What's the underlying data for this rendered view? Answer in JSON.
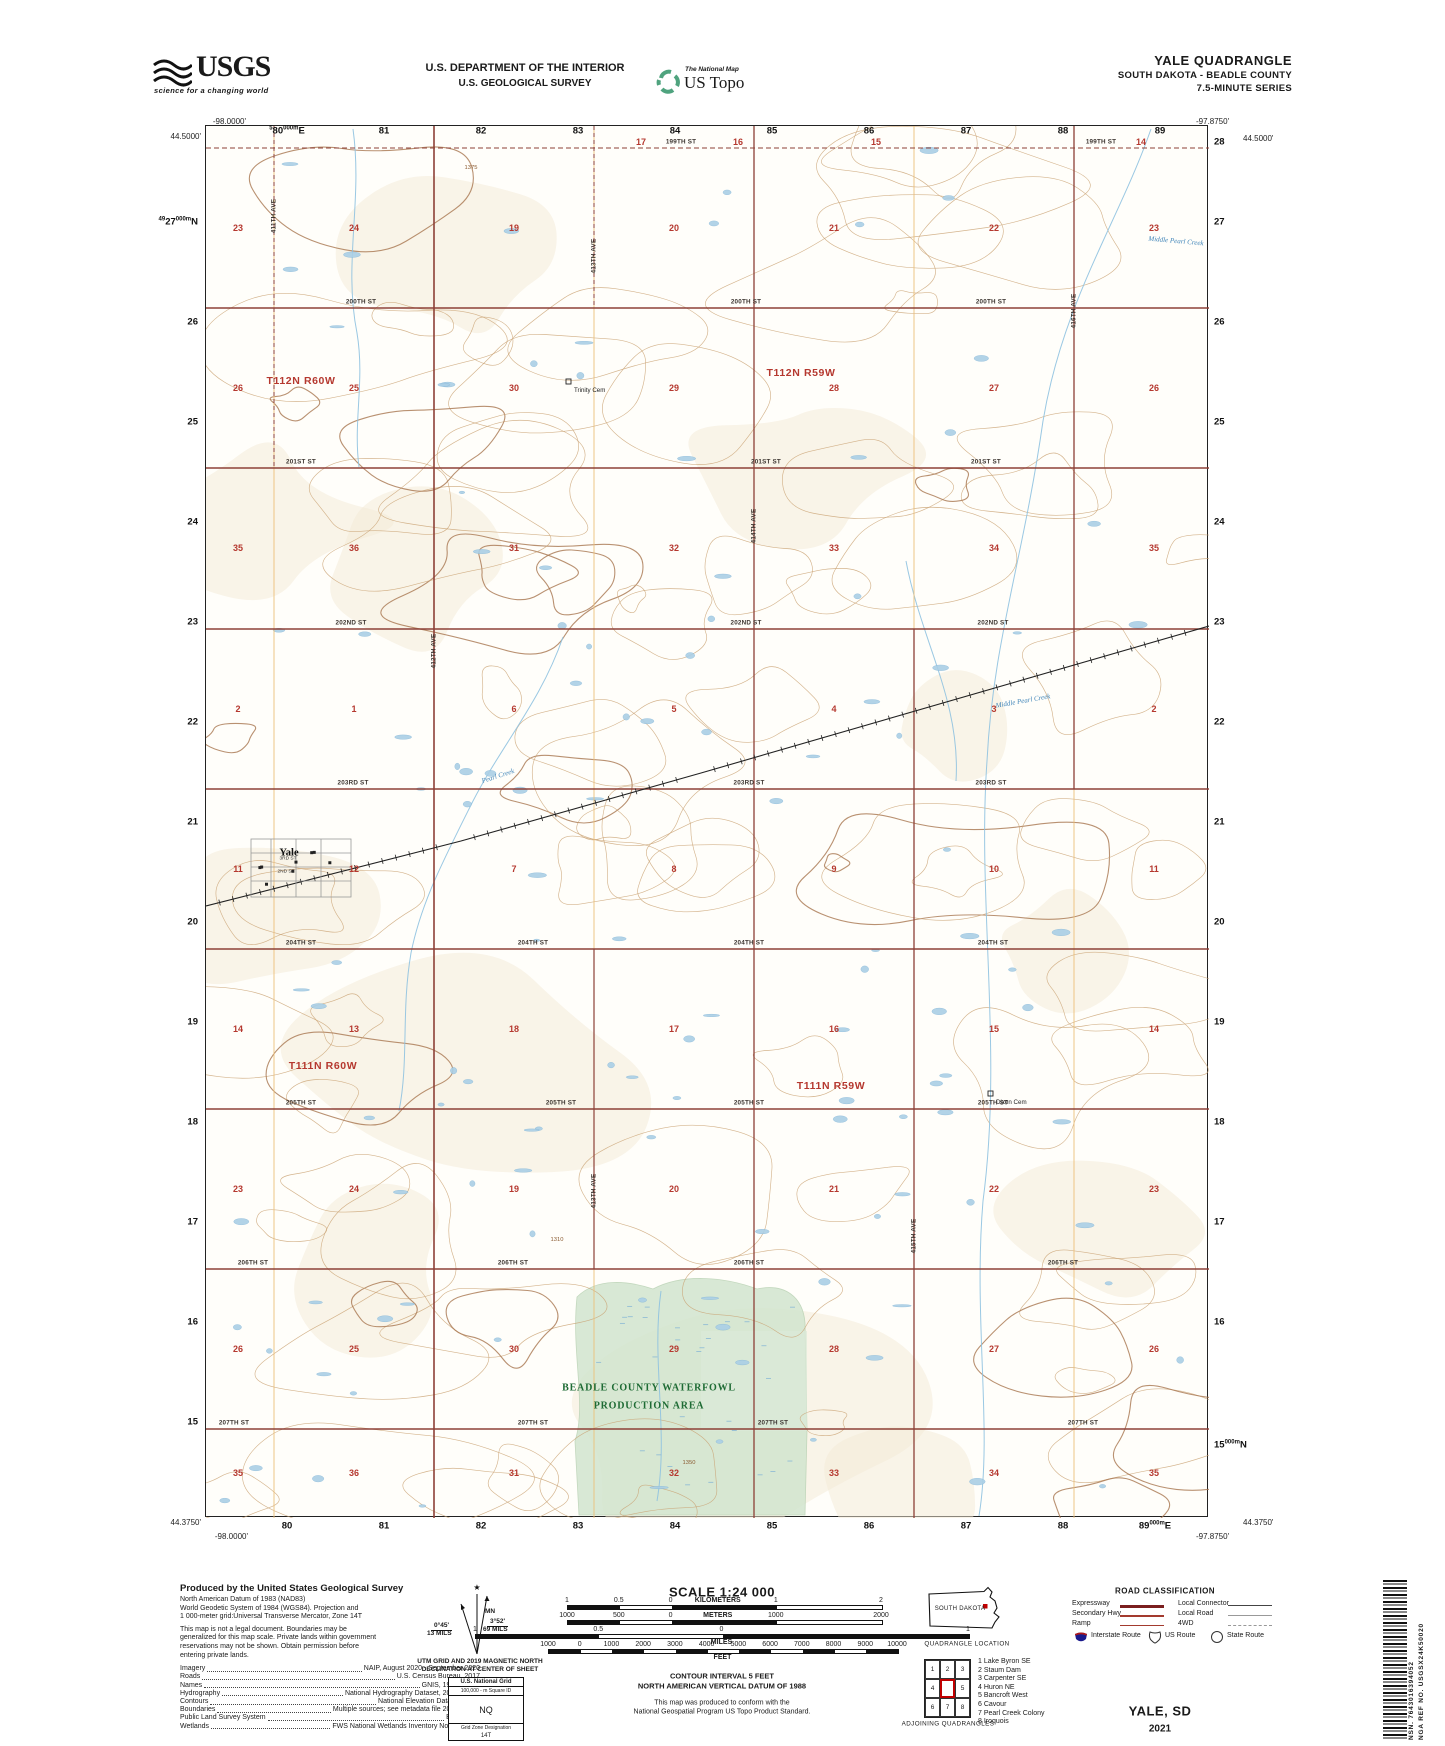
{
  "header": {
    "usgs": {
      "word": "USGS",
      "tagline": "science for a changing world"
    },
    "agency_line1": "U.S. DEPARTMENT OF THE INTERIOR",
    "agency_line2": "U.S. GEOLOGICAL SURVEY",
    "ustopo": {
      "small": "The National Map",
      "big": "US Topo"
    },
    "title": "YALE QUADRANGLE",
    "subtitle": "SOUTH DAKOTA - BEADLE COUNTY",
    "series": "7.5-MINUTE SERIES"
  },
  "map": {
    "corners": {
      "top_left": {
        "lon": "-98.0000'",
        "lat": "44.5000'"
      },
      "top_right": {
        "lon": "-97.8750'",
        "lat": "44.5000'"
      },
      "bottom_left": {
        "lat": "44.3750'",
        "lon": "-98.0000'"
      },
      "bottom_right": {
        "lat": "44.3750'",
        "lon": "-97.8750'"
      }
    },
    "grid": {
      "top": [
        {
          "x": 287,
          "main": "80",
          "pre": "5",
          "mid": "000m",
          "end": "E"
        },
        {
          "x": 384,
          "main": "81"
        },
        {
          "x": 481,
          "main": "82"
        },
        {
          "x": 578,
          "main": "83"
        },
        {
          "x": 675,
          "main": "84"
        },
        {
          "x": 772,
          "main": "85"
        },
        {
          "x": 869,
          "main": "86"
        },
        {
          "x": 966,
          "main": "87"
        },
        {
          "x": 1063,
          "main": "88"
        },
        {
          "x": 1160,
          "main": "89"
        }
      ],
      "bottom": [
        {
          "x": 287,
          "main": "80"
        },
        {
          "x": 384,
          "main": "81"
        },
        {
          "x": 481,
          "main": "82"
        },
        {
          "x": 578,
          "main": "83"
        },
        {
          "x": 675,
          "main": "84"
        },
        {
          "x": 772,
          "main": "85"
        },
        {
          "x": 869,
          "main": "86"
        },
        {
          "x": 966,
          "main": "87"
        },
        {
          "x": 1063,
          "main": "88"
        },
        {
          "x": 1155,
          "main": "89",
          "mid": "000m",
          "end": "E"
        }
      ],
      "left": [
        {
          "y": 222,
          "main": "27",
          "pre": "49",
          "mid": "000m",
          "end": "N"
        },
        {
          "y": 322,
          "main": "26"
        },
        {
          "y": 422,
          "main": "25"
        },
        {
          "y": 522,
          "main": "24"
        },
        {
          "y": 622,
          "main": "23"
        },
        {
          "y": 722,
          "main": "22"
        },
        {
          "y": 822,
          "main": "21"
        },
        {
          "y": 922,
          "main": "20"
        },
        {
          "y": 1022,
          "main": "19"
        },
        {
          "y": 1122,
          "main": "18"
        },
        {
          "y": 1222,
          "main": "17"
        },
        {
          "y": 1322,
          "main": "16"
        },
        {
          "y": 1422,
          "main": "15"
        }
      ],
      "right": [
        {
          "y": 142,
          "main": "28"
        },
        {
          "y": 222,
          "main": "27"
        },
        {
          "y": 322,
          "main": "26"
        },
        {
          "y": 422,
          "main": "25"
        },
        {
          "y": 522,
          "main": "24"
        },
        {
          "y": 622,
          "main": "23"
        },
        {
          "y": 722,
          "main": "22"
        },
        {
          "y": 822,
          "main": "21"
        },
        {
          "y": 922,
          "main": "20"
        },
        {
          "y": 1022,
          "main": "19"
        },
        {
          "y": 1122,
          "main": "18"
        },
        {
          "y": 1222,
          "main": "17"
        },
        {
          "y": 1322,
          "main": "16"
        },
        {
          "y": 1445,
          "main": "15",
          "mid": "000m",
          "end": "N"
        }
      ]
    },
    "townships": [
      {
        "label": "T112N R60W",
        "x": 300,
        "y": 380
      },
      {
        "label": "T112N R59W",
        "x": 800,
        "y": 372
      },
      {
        "label": "T111N R60W",
        "x": 322,
        "y": 1065
      },
      {
        "label": "T111N R59W",
        "x": 830,
        "y": 1085
      }
    ],
    "sections": {
      "cols": [
        237,
        353,
        513,
        673,
        833,
        993,
        1153
      ],
      "rows": [
        {
          "y": 227,
          "n": [
            "23",
            "24",
            "19",
            "20",
            "21",
            "22",
            "23"
          ]
        },
        {
          "y": 387,
          "n": [
            "26",
            "25",
            "30",
            "29",
            "28",
            "27",
            "26"
          ]
        },
        {
          "y": 547,
          "n": [
            "35",
            "36",
            "31",
            "32",
            "33",
            "34",
            "35"
          ]
        },
        {
          "y": 708,
          "n": [
            "2",
            "1",
            "6",
            "5",
            "4",
            "3",
            "2"
          ]
        },
        {
          "y": 868,
          "n": [
            "11",
            "12",
            "7",
            "8",
            "9",
            "10",
            "11"
          ]
        },
        {
          "y": 1028,
          "n": [
            "14",
            "13",
            "18",
            "17",
            "16",
            "15",
            "14"
          ]
        },
        {
          "y": 1188,
          "n": [
            "23",
            "24",
            "19",
            "20",
            "21",
            "22",
            "23"
          ]
        },
        {
          "y": 1348,
          "n": [
            "26",
            "25",
            "30",
            "29",
            "28",
            "27",
            "26"
          ]
        },
        {
          "y": 1472,
          "n": [
            "35",
            "36",
            "31",
            "32",
            "33",
            "34",
            "35"
          ]
        }
      ],
      "top_partial": [
        {
          "x": 640,
          "n": "17"
        },
        {
          "x": 737,
          "n": "16"
        },
        {
          "x": 875,
          "n": "15"
        },
        {
          "x": 1140,
          "n": "14"
        }
      ]
    },
    "roads": [
      {
        "name": "199TH ST",
        "y": 147,
        "lx": [
          680,
          1100
        ]
      },
      {
        "name": "200TH ST",
        "y": 307,
        "lx": [
          360,
          745,
          990
        ]
      },
      {
        "name": "201ST ST",
        "y": 467,
        "lx": [
          300,
          765,
          985
        ]
      },
      {
        "name": "202ND ST",
        "y": 628,
        "lx": [
          350,
          745,
          992
        ]
      },
      {
        "name": "203RD ST",
        "y": 788,
        "lx": [
          352,
          748,
          990
        ]
      },
      {
        "name": "204TH ST",
        "y": 948,
        "lx": [
          300,
          532,
          748,
          992
        ]
      },
      {
        "name": "205TH ST",
        "y": 1108,
        "lx": [
          300,
          560,
          748,
          992
        ]
      },
      {
        "name": "206TH ST",
        "y": 1268,
        "lx": [
          252,
          512,
          748,
          1062
        ]
      },
      {
        "name": "207TH ST",
        "y": 1428,
        "lx": [
          233,
          532,
          772,
          1082
        ]
      }
    ],
    "avenues": [
      {
        "name": "411TH AVE",
        "x": 273,
        "ly": [
          215
        ]
      },
      {
        "name": "412TH AVE",
        "x": 433,
        "ly": [
          650
        ]
      },
      {
        "name": "413TH AVE",
        "x": 593,
        "ly": [
          255,
          1190
        ]
      },
      {
        "name": "414TH AVE",
        "x": 753,
        "ly": [
          525
        ]
      },
      {
        "name": "415TH AVE",
        "x": 913,
        "ly": [
          1235
        ]
      },
      {
        "name": "416TH AVE",
        "x": 1073,
        "ly": [
          310
        ]
      }
    ],
    "places": [
      {
        "label": "Yale",
        "x": 288,
        "y": 852
      }
    ],
    "town_streets": [
      {
        "label": "3RD ST",
        "x": 287,
        "y": 858
      },
      {
        "label": "2ND ST",
        "x": 285,
        "y": 871
      }
    ],
    "cemeteries": [
      {
        "label": "Trinity Cem",
        "x": 573,
        "y": 386
      },
      {
        "label": "Dixon Cem",
        "x": 995,
        "y": 1098
      }
    ],
    "streams": [
      {
        "label": "Middle Pearl Creek",
        "x": 1175,
        "y": 240,
        "rot": 95
      },
      {
        "label": "Middle Pearl Creek",
        "x": 1022,
        "y": 700,
        "rot": 80
      },
      {
        "label": "Pearl Creek",
        "x": 497,
        "y": 775,
        "rot": 72
      }
    ],
    "contour_labels": [
      {
        "label": "1375",
        "x": 470,
        "y": 167
      },
      {
        "label": "1310",
        "x": 556,
        "y": 1239
      },
      {
        "label": "1350",
        "x": 688,
        "y": 1462
      }
    ],
    "waterfowl": {
      "line1": "BEADLE COUNTY WATERFOWL",
      "line2": "PRODUCTION AREA",
      "x": 648,
      "y1": 1387,
      "y2": 1405
    }
  },
  "footer": {
    "credits": {
      "heading": "Produced by the United States Geological Survey",
      "datum_lines": [
        "North American Datum of 1983 (NAD83)",
        "World Geodetic System of 1984 (WGS84).  Projection and",
        "1 000-meter grid:Universal Transverse Mercator, Zone 14T"
      ],
      "legal_lines": [
        "This map is not a legal document. Boundaries may be",
        "generalized for this map scale. Private lands within government",
        "reservations may not be shown. Obtain permission before",
        "entering private lands."
      ],
      "sources": [
        {
          "term": "Imagery",
          "value": "NAIP, August 2020 - September 2020"
        },
        {
          "term": "Roads",
          "value": "U.S. Census Bureau, 2017"
        },
        {
          "term": "Names",
          "value": "GNIS, 1980 - 2020"
        },
        {
          "term": "Hydrography",
          "value": "National Hydrography Dataset, 2006 - 2019"
        },
        {
          "term": "Contours",
          "value": "National Elevation Dataset, 2014"
        },
        {
          "term": "Boundaries",
          "value": "Multiple sources; see metadata file 2016 - 2021"
        },
        {
          "term": "Public Land Survey System",
          "value": "BLM, 2017"
        },
        {
          "term": "Wetlands",
          "value": "FWS National Wetlands Inventory Not Available"
        }
      ]
    },
    "declination": {
      "mn_label": "MN",
      "gn_deg": "0°45'",
      "gn_mils": "13 MILS",
      "mn_deg": "3°52'",
      "mn_mils": "69 MILS",
      "caption1": "UTM GRID AND 2019 MAGNETIC NORTH",
      "caption2": "DECLINATION AT CENTER OF SHEET"
    },
    "natgrid": {
      "title": "U.S. National Grid",
      "square_label": "100,000 - m Square ID",
      "square_id": "NQ",
      "zone_label": "Grid Zone Designation",
      "zone": "14T"
    },
    "scale": {
      "title": "SCALE 1:24 000",
      "bars": [
        {
          "unit": "KILOMETERS",
          "inline": true,
          "x": 567,
          "w": 314,
          "laby": 1597,
          "bary": 1605,
          "ticks": [
            {
              "t": "1",
              "p": 0
            },
            {
              "t": "0.5",
              "p": 0.165
            },
            {
              "t": "0",
              "p": 0.33
            },
            {
              "t": "1",
              "p": 0.665
            },
            {
              "t": "2",
              "p": 1
            }
          ],
          "unit_p": 0.48
        },
        {
          "unit": "METERS",
          "inline": true,
          "x": 567,
          "w": 314,
          "laby": 1612,
          "bary": 1620,
          "ticks": [
            {
              "t": "1000",
              "p": 0
            },
            {
              "t": "500",
              "p": 0.165
            },
            {
              "t": "0",
              "p": 0.33
            },
            {
              "t": "1000",
              "p": 0.665
            },
            {
              "t": "2000",
              "p": 1
            }
          ],
          "unit_p": 0.48
        },
        {
          "unit": "MILES",
          "inline": false,
          "x": 475,
          "w": 493,
          "laby": 1626,
          "bary": 1634,
          "ticks": [
            {
              "t": "1",
              "p": 0
            },
            {
              "t": "0.5",
              "p": 0.25
            },
            {
              "t": "0",
              "p": 0.5
            },
            {
              "t": "1",
              "p": 1
            }
          ],
          "unit_p": 0.5
        },
        {
          "unit": "FEET",
          "inline": false,
          "x": 548,
          "w": 349,
          "laby": 1641,
          "bary": 1649,
          "ticks": [
            {
              "t": "1000",
              "p": 0
            },
            {
              "t": "0",
              "p": 0.0909
            },
            {
              "t": "1000",
              "p": 0.1818
            },
            {
              "t": "2000",
              "p": 0.2727
            },
            {
              "t": "3000",
              "p": 0.3636
            },
            {
              "t": "4000",
              "p": 0.4545
            },
            {
              "t": "5000",
              "p": 0.5455
            },
            {
              "t": "6000",
              "p": 0.6364
            },
            {
              "t": "7000",
              "p": 0.7273
            },
            {
              "t": "8000",
              "p": 0.8182
            },
            {
              "t": "9000",
              "p": 0.9091
            },
            {
              "t": "10000",
              "p": 1
            }
          ],
          "unit_p": 0.5
        }
      ],
      "contour_line1": "CONTOUR INTERVAL 5 FEET",
      "contour_line2": "NORTH AMERICAN VERTICAL DATUM OF 1988",
      "conform_line1": "This map was produced to conform with the",
      "conform_line2": "National Geospatial Program US Topo Product Standard."
    },
    "location": {
      "state": "SOUTH DAKOTA",
      "caption": "QUADRANGLE LOCATION"
    },
    "adjoining": {
      "caption": "ADJOINING QUADRANGLES",
      "cells": [
        "1",
        "2",
        "3",
        "4",
        "",
        "5",
        "6",
        "7",
        "8"
      ],
      "names": [
        "1 Lake Byron SE",
        "2 Staum Dam",
        "3 Carpenter SE",
        "4 Huron NE",
        "5 Bancroft West",
        "6 Cavour",
        "7 Pearl Creek Colony",
        "8 Iroquois"
      ]
    },
    "road_class": {
      "title": "ROAD CLASSIFICATION",
      "left": [
        {
          "label": "Expressway",
          "style": "expressway"
        },
        {
          "label": "Secondary Hwy",
          "style": "secondary"
        },
        {
          "label": "Ramp",
          "style": "ramp"
        }
      ],
      "right": [
        {
          "label": "Local Connector",
          "style": "connector"
        },
        {
          "label": "Local Road",
          "style": "local"
        },
        {
          "label": "4WD",
          "style": "fourwd"
        }
      ],
      "shields": [
        {
          "label": "Interstate Route",
          "type": "interstate"
        },
        {
          "label": "US Route",
          "type": "us"
        },
        {
          "label": "State Route",
          "type": "state"
        }
      ]
    },
    "ids": {
      "map_name": "YALE, SD",
      "year": "2021",
      "nsn": "NSN. 7643016394052",
      "nga": "NGA REF NO. USGSX24K50020"
    }
  },
  "colors": {
    "section_red": "#b5382f",
    "road_maroon": "#8d4037",
    "grid_orange": "#ecc07a",
    "contour_brown": "#c9a172",
    "water_blue": "#aacfe6",
    "wfp_green_fill": "#d2e5cf",
    "wfp_green_text": "#1e6b34",
    "usgs_green": "#4fa37e",
    "interstate_blue": "#1a1a8c",
    "interstate_red": "#b01818"
  }
}
